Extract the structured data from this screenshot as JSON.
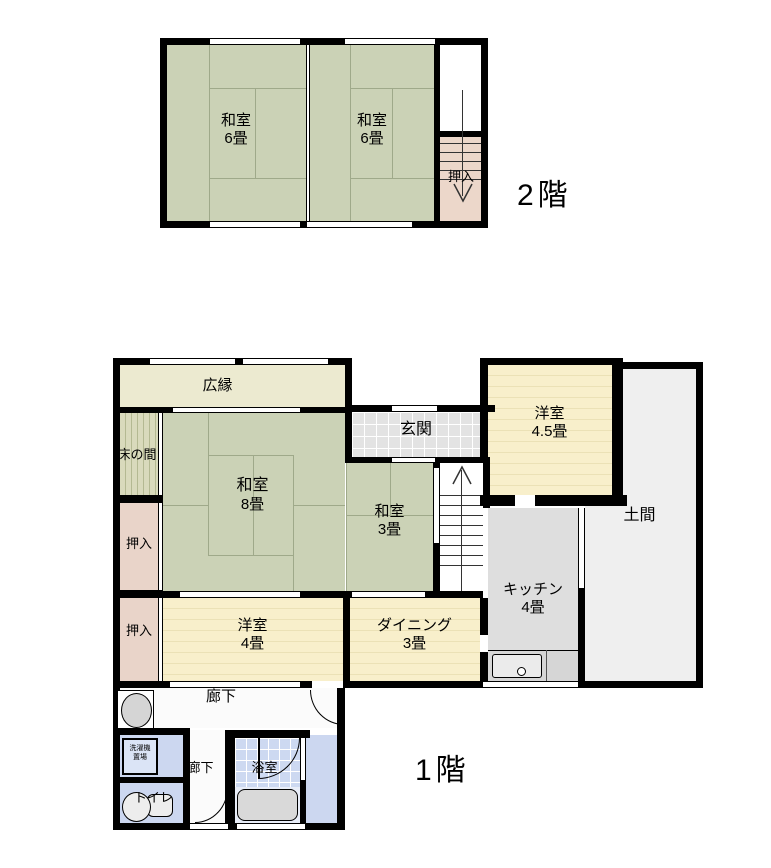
{
  "palette": {
    "wall": "#000000",
    "tatami_green": "#cbd2b6",
    "veranda_cream": "#ecead0",
    "western_room_cream": "#f8efcb",
    "closet_pink": "#e9d4c9",
    "stair_closet_pink": "#ecd7ca",
    "entry_tile_gray": "#e3e3e3",
    "doma_gray": "#efefef",
    "kitchen_gray": "#dedede",
    "wet_area_blue": "#ccd7f0",
    "bath_tile_blue": "#cdd9f1"
  },
  "floor2": {
    "title": "2階",
    "washitsu_a": {
      "name": "和室",
      "size": "6畳"
    },
    "washitsu_b": {
      "name": "和室",
      "size": "6畳"
    },
    "oshiire": {
      "name": "押入"
    }
  },
  "floor1": {
    "title": "1階",
    "hiroen": {
      "name": "広縁"
    },
    "tokonoma": {
      "name": "床の間"
    },
    "oshiire_a": {
      "name": "押入"
    },
    "oshiire_b": {
      "name": "押入"
    },
    "washitsu8": {
      "name": "和室",
      "size": "8畳"
    },
    "washitsu3": {
      "name": "和室",
      "size": "3畳"
    },
    "genkan": {
      "name": "玄関"
    },
    "yoshitsu45": {
      "name": "洋室",
      "size": "4.5畳"
    },
    "doma": {
      "name": "土間"
    },
    "kitchen": {
      "name": "キッチン",
      "size": "4畳"
    },
    "yoshitsu4": {
      "name": "洋室",
      "size": "4畳"
    },
    "dining": {
      "name": "ダイニング",
      "size": "3畳"
    },
    "rouka_a": {
      "name": "廊下"
    },
    "rouka_b": {
      "name": "廊下"
    },
    "laundry": {
      "line1": "洗濯機",
      "line2": "置場"
    },
    "bath": {
      "name": "浴室"
    },
    "toilet": {
      "name": "トイレ"
    }
  }
}
